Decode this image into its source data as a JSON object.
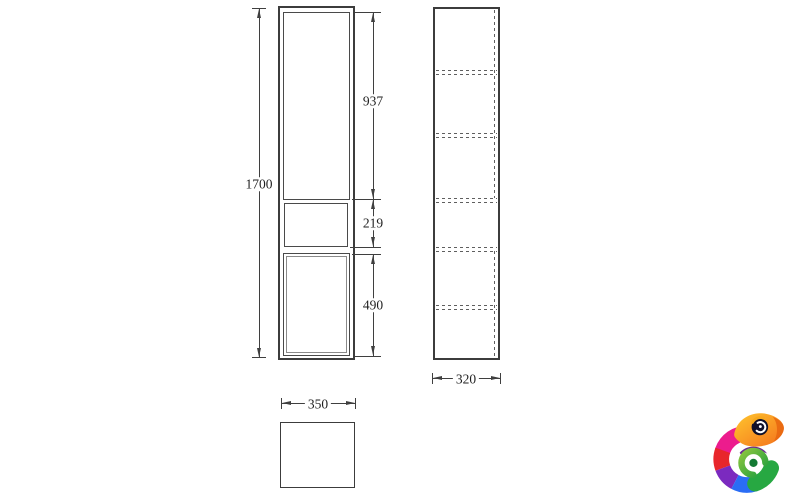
{
  "drawing": {
    "type": "furniture-technical-drawing",
    "views": [
      "front-elevation",
      "side-elevation",
      "plan"
    ],
    "dimensions": {
      "total_height": "1700",
      "upper_door_height": "937",
      "open_shelf_height": "219",
      "lower_door_height": "490",
      "width": "350",
      "depth": "320"
    },
    "colors": {
      "line": "#3f3f3f",
      "text": "#1f1f1f",
      "background": "#ffffff"
    }
  },
  "logo": {
    "name": "chameleon-logo",
    "colors": {
      "head": "#f4711c",
      "pink": "#ec1c8d",
      "red": "#e8262b",
      "purple": "#7b2abf",
      "blue": "#2a6df5",
      "green": "#27a842"
    }
  }
}
